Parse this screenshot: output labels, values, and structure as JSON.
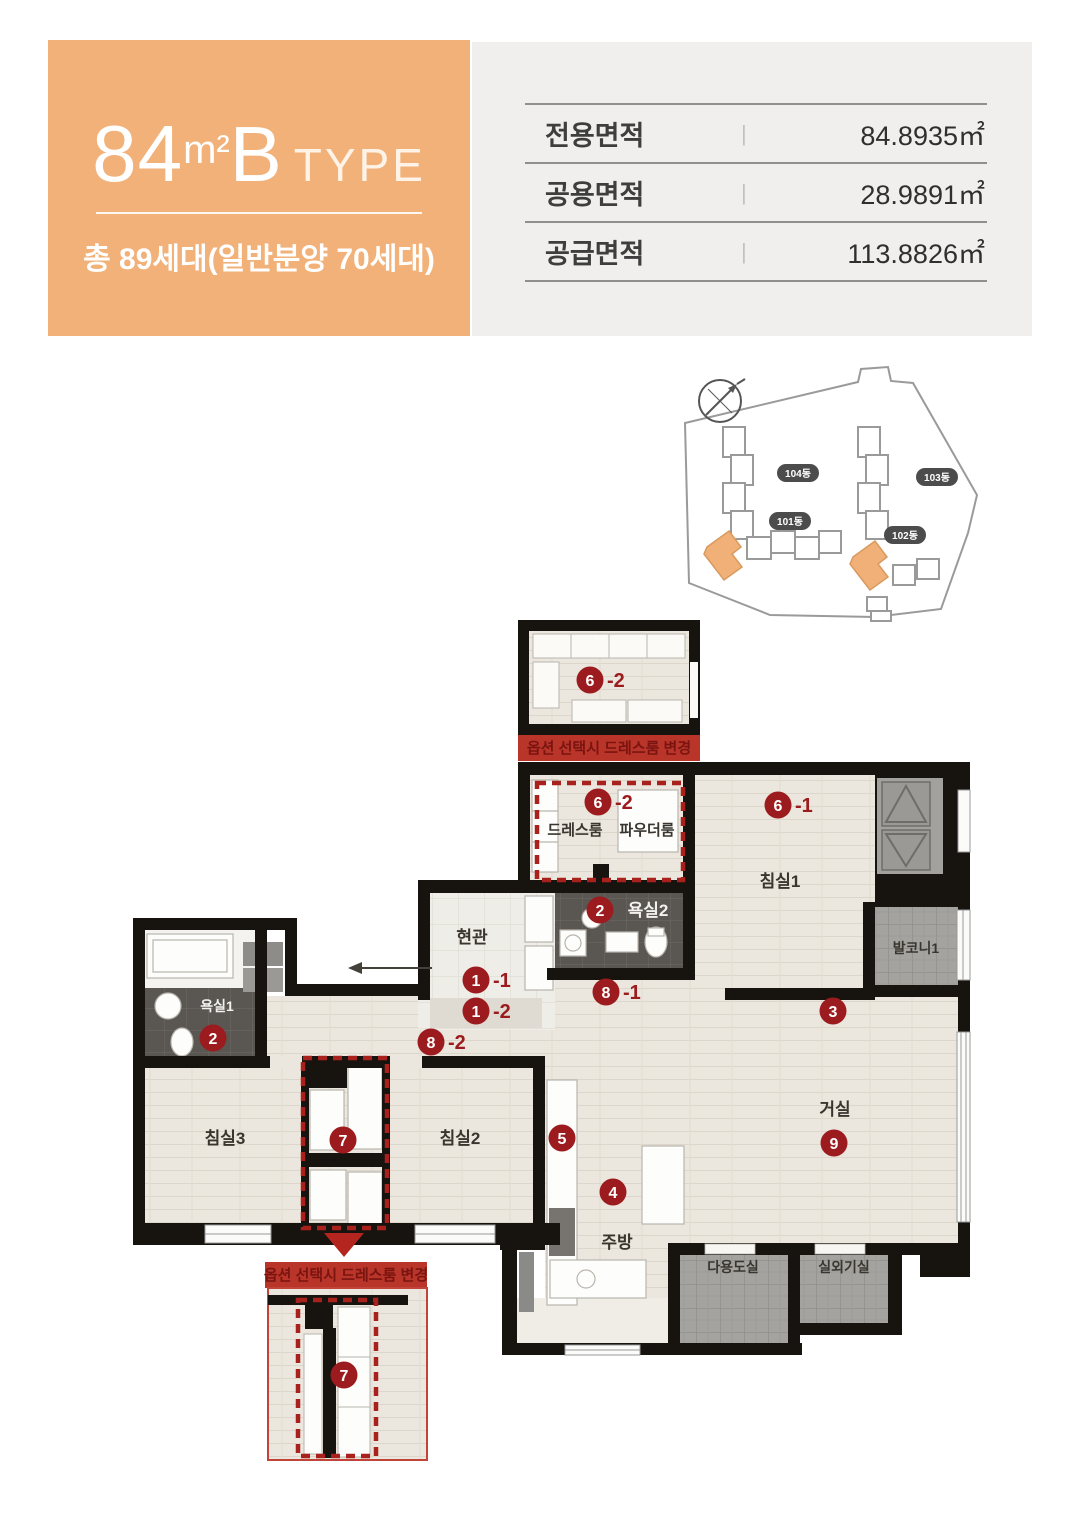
{
  "header": {
    "area_number": "84",
    "area_unit": "m²",
    "type_letter": "B",
    "type_word": "TYPE",
    "subtitle": "총 89세대(일반분양 70세대)",
    "accent_color": "#F1B179"
  },
  "area_table": {
    "rows": [
      {
        "label": "전용면적",
        "value": "84.8935㎡"
      },
      {
        "label": "공용면적",
        "value": "28.9891㎡"
      },
      {
        "label": "공급면적",
        "value": "113.8826㎡"
      }
    ]
  },
  "site_plan": {
    "building_labels": [
      "104동",
      "103동",
      "101동",
      "102동"
    ]
  },
  "floor_plan": {
    "option_note": "옵션 선택시 드레스룸 변경",
    "rooms": {
      "bedroom1": "침실1",
      "bedroom2": "침실2",
      "bedroom3": "침실3",
      "living": "거실",
      "kitchen": "주방",
      "entrance": "현관",
      "bath1": "욕실1",
      "bath2": "욕실2",
      "dressroom": "드레스룸",
      "powder": "파우더룸",
      "balcony1": "발코니1",
      "utility": "다용도실",
      "outdoor_unit": "실외기실"
    },
    "markers": {
      "m1_1": {
        "num": "1",
        "suffix": "-1"
      },
      "m1_2": {
        "num": "1",
        "suffix": "-2"
      },
      "m2_bath2": {
        "num": "2",
        "suffix": ""
      },
      "m2_bath1": {
        "num": "2",
        "suffix": ""
      },
      "m3": {
        "num": "3",
        "suffix": ""
      },
      "m4": {
        "num": "4",
        "suffix": ""
      },
      "m5": {
        "num": "5",
        "suffix": ""
      },
      "m6_1": {
        "num": "6",
        "suffix": "-1"
      },
      "m6_2": {
        "num": "6",
        "suffix": "-2"
      },
      "m6_2_option": {
        "num": "6",
        "suffix": "-2"
      },
      "m7": {
        "num": "7",
        "suffix": ""
      },
      "m7_option": {
        "num": "7",
        "suffix": ""
      },
      "m8_1": {
        "num": "8",
        "suffix": "-1"
      },
      "m8_2": {
        "num": "8",
        "suffix": "-2"
      },
      "m9": {
        "num": "9",
        "suffix": ""
      }
    },
    "colors": {
      "marker_red": "#9C1B1E",
      "banner_red": "#B93529",
      "wall": "#17130F"
    }
  }
}
